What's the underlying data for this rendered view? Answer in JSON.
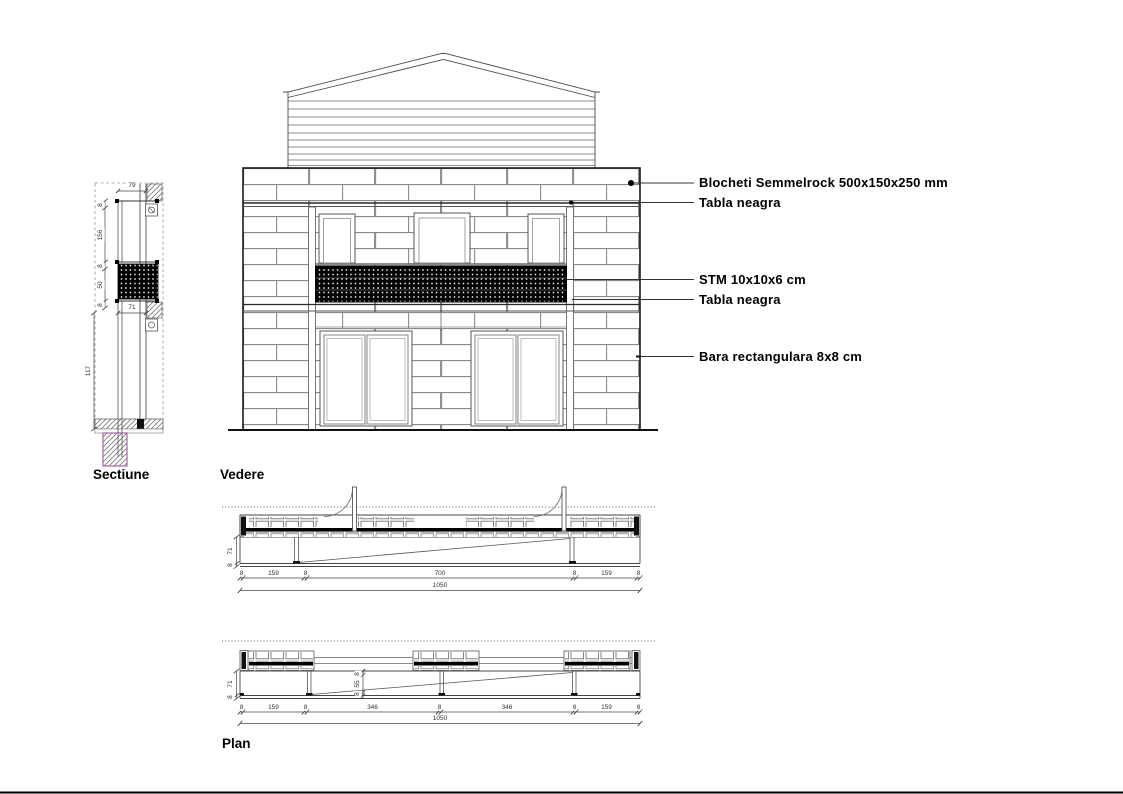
{
  "titles": {
    "section": "Sectiune",
    "elevation": "Vedere",
    "plan": "Plan"
  },
  "annotations": {
    "items": [
      "Blocheti Semmelrock 500x150x250 mm",
      "Tabla neagra",
      "STM 10x10x6 cm",
      "Tabla neagra",
      "Bara rectangulara 8x8 cm"
    ]
  },
  "section_dims": {
    "top_width": "79",
    "chain": [
      "8",
      "156",
      "8",
      "50",
      "8"
    ],
    "inner_width": "71",
    "total_height": "117"
  },
  "plan_top_dims": {
    "side_height": "71",
    "side_base": "8",
    "row": [
      "8",
      "159",
      "8",
      "700",
      "8",
      "159",
      "8"
    ],
    "total": "1050"
  },
  "plan_bottom_dims": {
    "side_height": "71",
    "side_base": "8",
    "mid_chain": [
      "8",
      "55",
      "8"
    ],
    "row": [
      "8",
      "159",
      "8",
      "346",
      "8",
      "346",
      "8",
      "159",
      "8"
    ],
    "total": "1050"
  },
  "colors": {
    "line": "#333333",
    "brick_line": "#8a8a8a",
    "mesh": "#000000",
    "foundation_outline": "#b06fae",
    "background": "#ffffff"
  }
}
